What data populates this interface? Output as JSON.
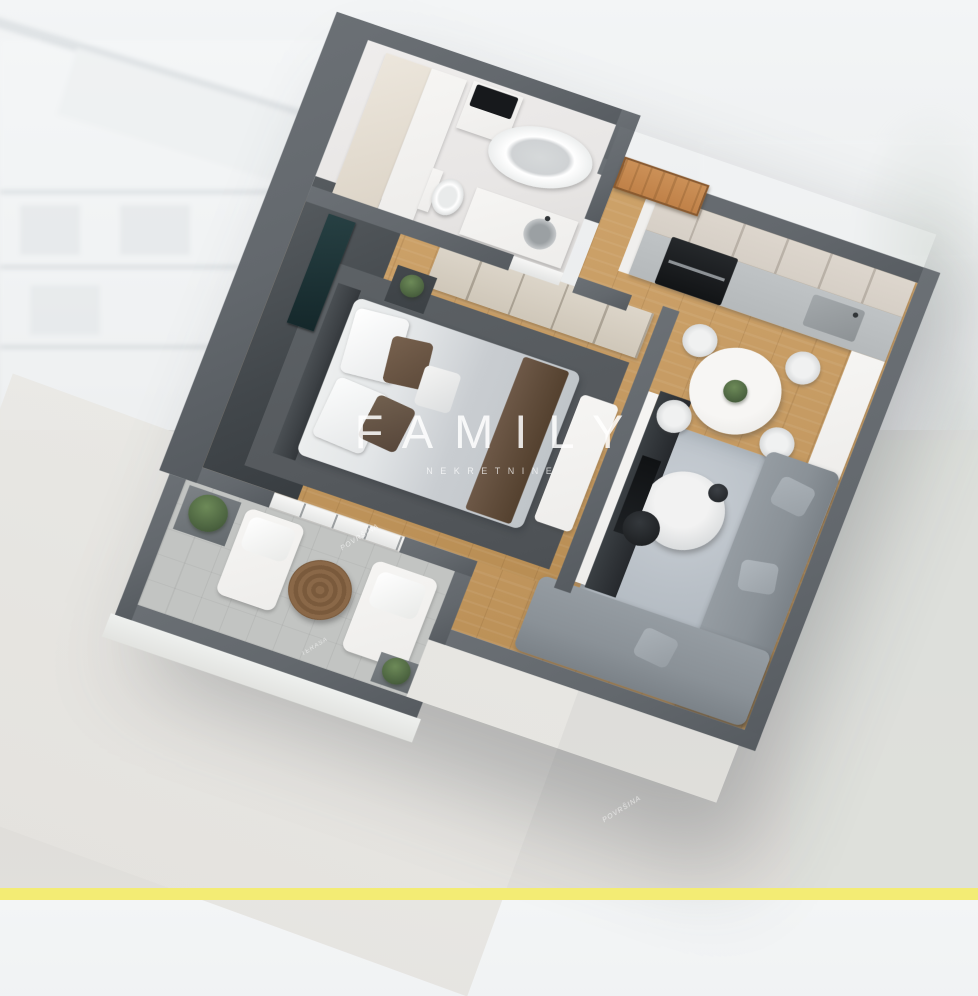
{
  "watermark": {
    "title": "FAMILY",
    "subtitle": "NEKRETNINE"
  },
  "wall_labels": {
    "bedroom": "POVRŠINA",
    "terrace": "TERASA",
    "living": "POVRŠINA"
  },
  "colors": {
    "accent_bar": "#f3ec74",
    "outer_wall": "#63686d",
    "accent_wall": "#3c4145",
    "wood": "#c49961",
    "bath_floor": "#e8e6e5",
    "bed_rug": "#55595d",
    "living_rug": "#b9c0c7",
    "sofa": "#8a9197",
    "cabinet": "#d6cfc6",
    "counter": "#b5b9bb",
    "door_wood": "#c08148",
    "terrace_floor": "#c2c4c2",
    "white_furn": "#eeedeb",
    "plant": "#49603e"
  }
}
